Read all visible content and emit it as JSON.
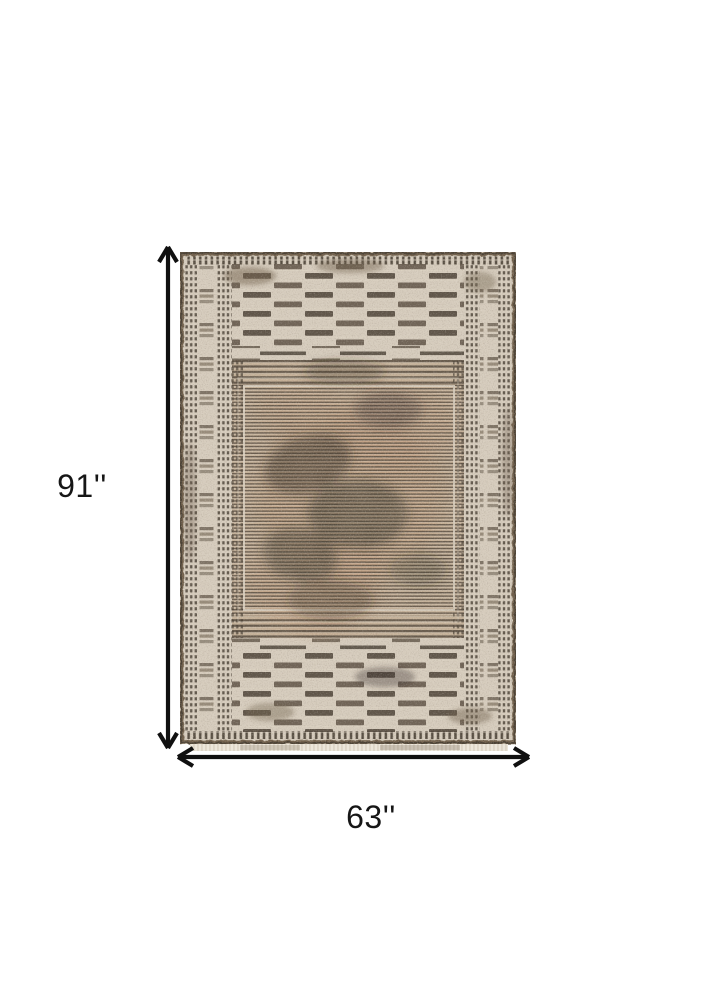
{
  "page": {
    "background_color": "#ffffff"
  },
  "product_image": {
    "kind": "rug-top-view-photo",
    "description": "Beige and gray distressed flatweave area rug with checkered border bands and striped center field",
    "colors": {
      "base": "#d6ccbd",
      "base_light": "#ddd4c6",
      "field_bg": "#c5b29a",
      "stripe_dark": "#5e5245",
      "dash_dark": "#453c31",
      "mid_dash": "#7b6e5d",
      "edge": "#6f5f4c",
      "blotch": "#352e26",
      "warm_tan": "#c09a7a",
      "light_line": "#ded5c5",
      "fringe": "#ece6da"
    }
  },
  "annotations": {
    "height_label": "91''",
    "width_label": "63''",
    "arrow_color": "#101010",
    "label_color": "#161616"
  }
}
